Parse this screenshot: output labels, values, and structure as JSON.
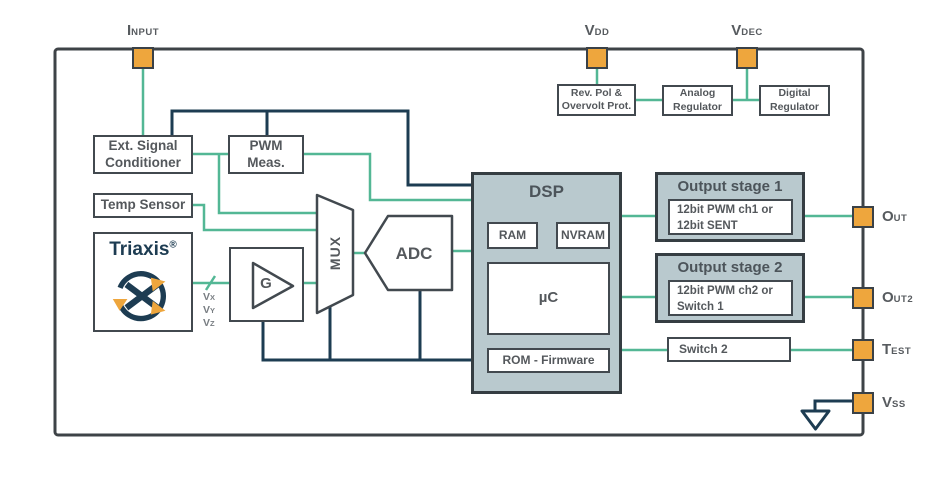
{
  "colors": {
    "teal": "#53b795",
    "navy": "#1d3c52",
    "line": "#42494f",
    "fill": "#b9c9ce",
    "orange": "#eea63d",
    "text": "#54585c",
    "subtle": "#787d82"
  },
  "pins": {
    "input": {
      "main": "I",
      "sub": "NPUT"
    },
    "vdd": {
      "main": "V",
      "sub": "DD"
    },
    "vdec": {
      "main": "V",
      "sub": "DEC"
    },
    "out": {
      "main": "O",
      "sub": "UT"
    },
    "out2": {
      "main": "O",
      "sub": "UT2"
    },
    "test": {
      "main": "T",
      "sub": "EST"
    },
    "vss": {
      "main": "V",
      "sub": "SS"
    }
  },
  "signals": {
    "vx": {
      "main": "V",
      "sub": "X"
    },
    "vy": {
      "main": "V",
      "sub": "Y"
    },
    "vz": {
      "main": "V",
      "sub": "Z"
    }
  },
  "blocks": {
    "ext_signal": {
      "line1": "Ext. Signal",
      "line2": "Conditioner"
    },
    "pwm_meas": {
      "line1": "PWM",
      "line2": "Meas."
    },
    "temp_sensor": {
      "label": "Temp Sensor"
    },
    "triaxis": {
      "label": "Triaxis",
      "reg": "®"
    },
    "gain": {
      "label": "G"
    },
    "mux": {
      "label": "MUX"
    },
    "adc": {
      "label": "ADC"
    },
    "rev_pol": {
      "line1": "Rev. Pol &",
      "line2": "Overvolt Prot."
    },
    "analog_reg": {
      "line1": "Analog",
      "line2": "Regulator"
    },
    "digital_reg": {
      "line1": "Digital",
      "line2": "Regulator"
    },
    "dsp": {
      "title": "DSP",
      "ram": "RAM",
      "nvram": "NVRAM",
      "uc": "µC",
      "rom": "ROM - Firmware"
    },
    "output_stage1": {
      "title": "Output stage 1",
      "line1": "12bit PWM ch1 or",
      "line2": "12bit SENT"
    },
    "output_stage2": {
      "title": "Output stage 2",
      "line1": "12bit PWM ch2 or",
      "line2": "Switch 1"
    },
    "switch2": {
      "label": "Switch 2"
    }
  }
}
